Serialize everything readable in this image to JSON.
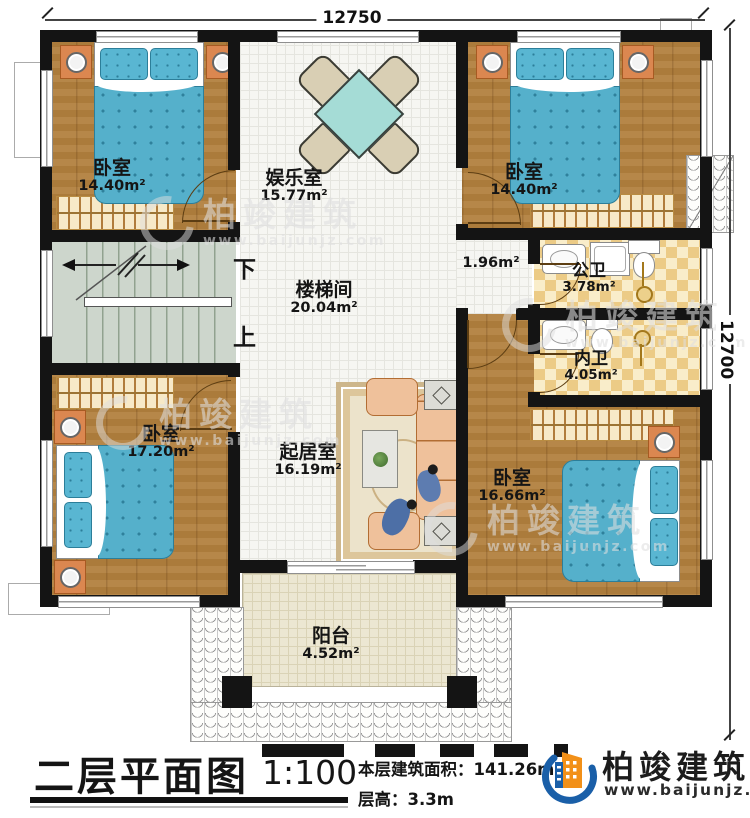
{
  "dimensions": {
    "top": "12750",
    "right": "12700"
  },
  "rooms": {
    "bedroom_tl": {
      "name": "卧室",
      "area": "14.40m²"
    },
    "entertainment": {
      "name": "娱乐室",
      "area": "15.77m²"
    },
    "bedroom_tr": {
      "name": "卧室",
      "area": "14.40m²"
    },
    "stairwell": {
      "name": "楼梯间",
      "area": "20.04m²"
    },
    "niche": {
      "area": "1.96m²"
    },
    "public_bath": {
      "name": "公卫",
      "area": "3.78m²"
    },
    "inner_bath": {
      "name": "内卫",
      "area": "4.05m²"
    },
    "bedroom_bl": {
      "name": "卧室",
      "area": "17.20m²"
    },
    "living": {
      "name": "起居室",
      "area": "16.19m²"
    },
    "bedroom_br": {
      "name": "卧室",
      "area": "16.66m²"
    },
    "balcony": {
      "name": "阳台",
      "area": "4.52m²"
    }
  },
  "stairs": {
    "down_label": "下",
    "up_label": "上"
  },
  "title_block": {
    "title": "二层平面图",
    "scale": "1:100",
    "area_label": "本层建筑面积：",
    "area_value": "141.26m²",
    "height_label": "层高：",
    "height_value": "3.3m"
  },
  "brand": {
    "name": "柏竣建筑",
    "website": "www.baijunjz.com"
  },
  "watermark": {
    "name": "柏竣建筑",
    "website": "www.baijunjz.com"
  },
  "colors": {
    "wall": "#141414",
    "wood_floor": "#b1803e",
    "tile_floor": "#f6f6f2",
    "bath_tile": "#eccb86",
    "stair_floor": "#cdd6cc",
    "balcony_floor": "#ece7d2",
    "bed_blue": "#55b0cb",
    "sofa_peach": "#efc19b",
    "wardrobe_tan": "#f7e9c8",
    "brand_blue": "#1a5fa8",
    "brand_orange": "#f29018"
  }
}
